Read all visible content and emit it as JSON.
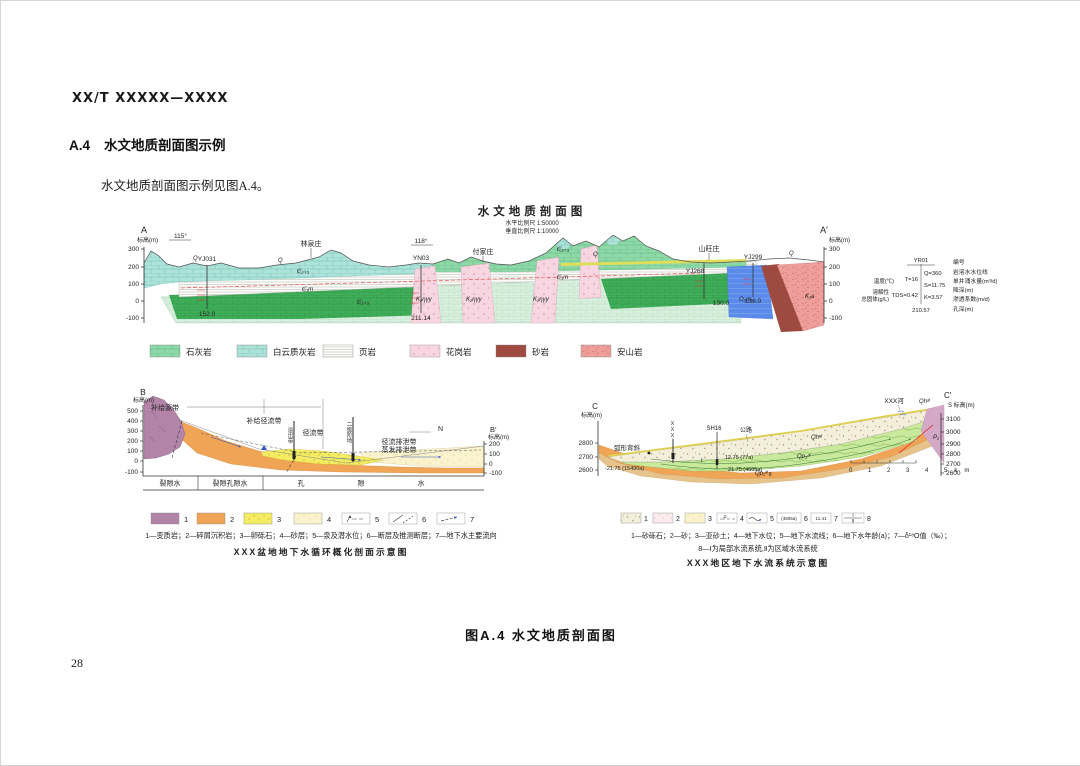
{
  "page": {
    "doc_code": "XX/T XXXXX—XXXX",
    "section_no": "A.4",
    "section_title": "水文地质剖面图示例",
    "intro": "水文地质剖面图示例见图A.4。",
    "figure_caption": "图A.4  水文地质剖面图",
    "page_number": "28"
  },
  "colors": {
    "limestone_green": "#8fd9a8",
    "dolomite_teal": "#aee3da",
    "shale_white": "#fdfdfb",
    "granite_pink": "#f7d6e2",
    "sandstone_darkred": "#9e4a40",
    "andesite_red": "#ef9f9b",
    "blue_unit": "#5b8bea",
    "metamorphic_purple": "#b184a8",
    "clastic_orange": "#f0a455",
    "gravel_yellow": "#f4ec62"
  },
  "profileA": {
    "title": "水文地质剖面图",
    "scale_h": "水平比例尺 1:50000",
    "scale_v": "垂直比例尺 1:10000",
    "end_left": "A",
    "end_right": "A′",
    "elev": "标高(m)",
    "ticks": [
      "300",
      "200",
      "100",
      "0",
      "-100"
    ],
    "bearing1": "115°",
    "bearing2": "118°",
    "v1": "林泉庄",
    "v2": "付家庄",
    "v3": "山旺庄",
    "bh1": "YJ031",
    "bh2": "YN03",
    "bh3": "YJ268",
    "bh4": "YJ299",
    "d1": "152.0",
    "d2": "211.14",
    "d3": "130.0",
    "d4": "136.0",
    "uq": "Q",
    "u_eps23": "∈₂₊₃",
    "u_eps1m": "∈₁m",
    "u_granite": "K₂ηγy",
    "u_blue": "O₂m",
    "u_andesite": "K₁a",
    "key": {
      "bh": "YR01",
      "temp_label": "温度(℃)",
      "temp_val": "T=16",
      "tds_label1": "溶解性",
      "tds_label2": "总固体(g/L)",
      "tds_val": "TDS=0.42",
      "q_val": "Q=360",
      "s_val": "S=11.75",
      "k_val": "K=3.57",
      "depth_val": "210.57",
      "r1": "编号",
      "r2": "岩溶水水位线",
      "r3": "单井涌水量(m³/d)",
      "r4": "降深(m)",
      "r5": "渗透系数(m/d)",
      "r6": "孔深(m)"
    },
    "legend": [
      {
        "label": "石灰岩"
      },
      {
        "label": "白云质灰岩"
      },
      {
        "label": "页岩"
      },
      {
        "label": "花岗岩"
      },
      {
        "label": "砂岩"
      },
      {
        "label": "安山岩"
      }
    ]
  },
  "profileB": {
    "end_left": "B",
    "end_right": "B′",
    "elev": "标高(m)",
    "tl": [
      "500",
      "400",
      "300",
      "200",
      "100",
      "0",
      "-100"
    ],
    "tr": [
      "200",
      "100",
      "0",
      "-100"
    ],
    "z1": "补给源带",
    "z2": "补给径流带",
    "z3": "径流带",
    "z4": "径流排泄带",
    "z5": "蒸发排泄带",
    "w1": "溢出带",
    "w2": "二级阶地",
    "north": "N",
    "s1": "裂隙水",
    "s2": "裂隙孔隙水",
    "s3": "孔",
    "s4": "隙",
    "s5": "水",
    "nums": [
      "1",
      "2",
      "3",
      "4",
      "5",
      "6",
      "7"
    ],
    "caption": "1—变质岩；2—碎屑沉积岩；3—卵砾石；4—砂层；5—泉及潜水位；6—断层及推测断层；7—地下水主要流向",
    "title": "XXX盆地地下水循环概化剖面示意图"
  },
  "profileC": {
    "end_left": "C",
    "end_right": "C′",
    "elevl": "标高(m)",
    "elevr": "S 标高(m)",
    "tl": [
      "2800",
      "2700",
      "2600"
    ],
    "tr": [
      "3100",
      "3000",
      "2900",
      "2800",
      "2700",
      "2600"
    ],
    "anticline": "弧形背斜",
    "xxx": "XXX",
    "bh": "SH16",
    "road": "公路",
    "river": "XXX河",
    "qh": "Qhᵃˡ",
    "qp3": "Qp₃ᵃˡ",
    "qp1": "Qp₁ᵃˡ",
    "p1": "P₁",
    "sys1": "Ⅰ",
    "sys2": "Ⅱ",
    "age1": "12.75 (77a)",
    "age2": "21.75 (4605a)",
    "age3": "-21.75 (15490a)",
    "scalebar": "0 1 2 3 4 5km",
    "nums": [
      "1",
      "2",
      "3",
      "4",
      "5",
      "6",
      "7",
      "8"
    ],
    "sym6": "(4605a)",
    "sym7": "11.41",
    "cap1": "1—砂砾石；2—砂；3—亚砂土；4—地下水位；5—地下水流线；6—地下水年龄(a)；7—δ¹⁸O值（‰）；",
    "cap2": "8—Ⅰ为局部水流系统,Ⅱ为区域水流系统",
    "title": "XXX地区地下水流系统示意图"
  }
}
